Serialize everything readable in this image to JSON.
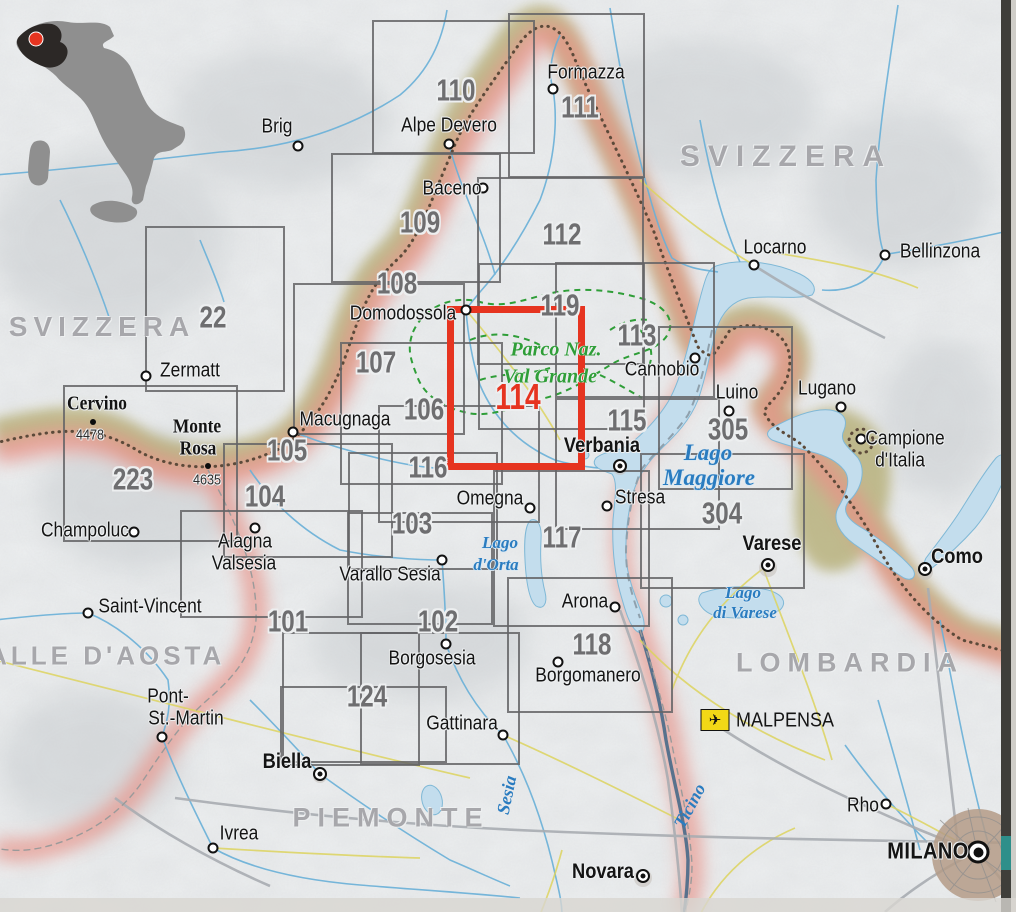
{
  "map": {
    "description": "Index map of hiking map sheets, Piedmont / Lake Maggiore area, with red highlighted sheet 114 Parco Nazionale Val Grande",
    "highlighted_sheet": "114"
  },
  "colors": {
    "paper": "#edeff0",
    "grid": "#68686a",
    "highlight_red": "#e63420",
    "park_green": "#2f9e38",
    "water_blue": "#2a7cc0",
    "region_gray": "#a7a7ab",
    "khaki_band": "#b2aa6e",
    "border_pink": "#e89287",
    "border_line": "#5c4a3a",
    "lake_fill": "#c3dded",
    "airport_yellow": "#f2d816",
    "urban_brown": "#b49b87"
  },
  "inset": {
    "name": "italy-locator",
    "marker": "red-dot",
    "marker_color": "#e63420"
  },
  "sheets": [
    {
      "number": "22",
      "x": 145,
      "y": 226,
      "w": 140,
      "h": 166,
      "lx": 213,
      "ly": 318
    },
    {
      "number": "110",
      "x": 372,
      "y": 20,
      "w": 163,
      "h": 134,
      "lx": 456,
      "ly": 91
    },
    {
      "number": "111",
      "x": 508,
      "y": 13,
      "w": 137,
      "h": 165,
      "lx": 580,
      "ly": 108
    },
    {
      "number": "109",
      "x": 331,
      "y": 153,
      "w": 170,
      "h": 130,
      "lx": 420,
      "ly": 223
    },
    {
      "number": "112",
      "x": 477,
      "y": 177,
      "w": 167,
      "h": 188,
      "lx": 562,
      "ly": 235
    },
    {
      "number": "108",
      "x": 293,
      "y": 283,
      "w": 172,
      "h": 152,
      "lx": 397,
      "ly": 284
    },
    {
      "number": "107",
      "x": 340,
      "y": 342,
      "w": 163,
      "h": 143,
      "lx": 376,
      "ly": 363
    },
    {
      "number": "119",
      "x": 478,
      "y": 263,
      "w": 167,
      "h": 167,
      "lx": 560,
      "ly": 306
    },
    {
      "number": "113",
      "x": 555,
      "y": 262,
      "w": 160,
      "h": 136,
      "lx": 637,
      "ly": 336
    },
    {
      "number": "106",
      "x": 378,
      "y": 405,
      "w": 162,
      "h": 118,
      "lx": 424,
      "ly": 410
    },
    {
      "number": "105",
      "x": 223,
      "y": 443,
      "w": 170,
      "h": 115,
      "lx": 287,
      "ly": 451
    },
    {
      "number": "104",
      "x": 180,
      "y": 510,
      "w": 183,
      "h": 108,
      "lx": 265,
      "ly": 497
    },
    {
      "number": "223",
      "x": 63,
      "y": 385,
      "w": 175,
      "h": 157,
      "lx": 133,
      "ly": 480
    },
    {
      "number": "116",
      "x": 348,
      "y": 452,
      "w": 150,
      "h": 118,
      "lx": 428,
      "ly": 468
    },
    {
      "number": "115",
      "x": 555,
      "y": 398,
      "w": 165,
      "h": 132,
      "lx": 627,
      "ly": 421
    },
    {
      "number": "305",
      "x": 658,
      "y": 326,
      "w": 135,
      "h": 164,
      "lx": 728,
      "ly": 430
    },
    {
      "number": "304",
      "x": 640,
      "y": 453,
      "w": 165,
      "h": 136,
      "lx": 722,
      "ly": 514
    },
    {
      "number": "103",
      "x": 347,
      "y": 512,
      "w": 146,
      "h": 113,
      "lx": 412,
      "ly": 524
    },
    {
      "number": "117",
      "x": 493,
      "y": 470,
      "w": 157,
      "h": 157,
      "lx": 562,
      "ly": 538
    },
    {
      "number": "101",
      "x": 282,
      "y": 632,
      "w": 138,
      "h": 134,
      "lx": 288,
      "ly": 622
    },
    {
      "number": "102",
      "x": 360,
      "y": 632,
      "w": 160,
      "h": 133,
      "lx": 438,
      "ly": 622
    },
    {
      "number": "118",
      "x": 507,
      "y": 577,
      "w": 166,
      "h": 136,
      "lx": 592,
      "ly": 645
    },
    {
      "number": "124",
      "x": 280,
      "y": 686,
      "w": 167,
      "h": 77,
      "lx": 367,
      "ly": 697
    },
    {
      "number": "114",
      "x": 447,
      "y": 306,
      "w": 138,
      "h": 164,
      "lx": 518,
      "ly": 398,
      "highlight": true
    }
  ],
  "places": [
    {
      "name": "Brig",
      "kind": "town",
      "dot": [
        298,
        146
      ],
      "lines": [
        {
          "t": "Brig",
          "x": 277,
          "y": 128
        }
      ]
    },
    {
      "name": "Formazza",
      "kind": "town",
      "dot": [
        553,
        89
      ],
      "lines": [
        {
          "t": "Formazza",
          "x": 586,
          "y": 74
        }
      ]
    },
    {
      "name": "Alpe Devero",
      "kind": "town",
      "dot": [
        449,
        144
      ],
      "lines": [
        {
          "t": "Alpe Devero",
          "x": 449,
          "y": 127
        }
      ]
    },
    {
      "name": "Baceno",
      "kind": "town",
      "dot": [
        483,
        188
      ],
      "lines": [
        {
          "t": "Baceno",
          "x": 452,
          "y": 190
        }
      ]
    },
    {
      "name": "Locarno",
      "kind": "town",
      "dot": [
        754,
        265
      ],
      "lines": [
        {
          "t": "Locarno",
          "x": 775,
          "y": 249
        }
      ]
    },
    {
      "name": "Bellinzona",
      "kind": "town",
      "dot": [
        885,
        255
      ],
      "lines": [
        {
          "t": "Bellinzona",
          "x": 940,
          "y": 253
        }
      ]
    },
    {
      "name": "Zermatt",
      "kind": "town",
      "dot": [
        146,
        376
      ],
      "lines": [
        {
          "t": "Zermatt",
          "x": 190,
          "y": 372
        }
      ]
    },
    {
      "name": "Domodossola",
      "kind": "town",
      "dot": [
        466,
        310
      ],
      "lines": [
        {
          "t": "Domodossola",
          "x": 403,
          "y": 315
        }
      ]
    },
    {
      "name": "Macugnaga",
      "kind": "town",
      "dot": [
        293,
        432
      ],
      "lines": [
        {
          "t": "Macugnaga",
          "x": 345,
          "y": 421
        }
      ]
    },
    {
      "name": "Cannobio",
      "kind": "town",
      "dot": [
        695,
        358
      ],
      "lines": [
        {
          "t": "Cannobio",
          "x": 662,
          "y": 371
        }
      ]
    },
    {
      "name": "Luino",
      "kind": "town",
      "dot": [
        729,
        411
      ],
      "lines": [
        {
          "t": "Luino",
          "x": 737,
          "y": 394
        }
      ]
    },
    {
      "name": "Lugano",
      "kind": "town",
      "dot": [
        841,
        407
      ],
      "lines": [
        {
          "t": "Lugano",
          "x": 827,
          "y": 390
        }
      ]
    },
    {
      "name": "Campione d'Italia",
      "kind": "town",
      "dot": [
        861,
        439
      ],
      "lines": [
        {
          "t": "Campione",
          "x": 905,
          "y": 440
        },
        {
          "t": "d'Italia",
          "x": 900,
          "y": 462
        }
      ]
    },
    {
      "name": "Champoluc",
      "kind": "town",
      "dot": [
        134,
        532
      ],
      "lines": [
        {
          "t": "Champoluc",
          "x": 85,
          "y": 532
        }
      ]
    },
    {
      "name": "Alagna Valsesia",
      "kind": "town",
      "dot": [
        255,
        528
      ],
      "lines": [
        {
          "t": "Alagna",
          "x": 245,
          "y": 543
        },
        {
          "t": "Valsesia",
          "x": 244,
          "y": 565
        }
      ]
    },
    {
      "name": "Saint-Vincent",
      "kind": "town",
      "dot": [
        88,
        613
      ],
      "lines": [
        {
          "t": "Saint-Vincent",
          "x": 150,
          "y": 608
        }
      ]
    },
    {
      "name": "Pont-St.-Martin",
      "kind": "town",
      "dot": [
        162,
        737
      ],
      "lines": [
        {
          "t": "Pont-",
          "x": 168,
          "y": 698
        },
        {
          "t": "St.-Martin",
          "x": 186,
          "y": 720
        }
      ]
    },
    {
      "name": "Ivrea",
      "kind": "town",
      "dot": [
        213,
        848
      ],
      "lines": [
        {
          "t": "Ivrea",
          "x": 239,
          "y": 835
        }
      ]
    },
    {
      "name": "Omegna",
      "kind": "town",
      "dot": [
        530,
        508
      ],
      "lines": [
        {
          "t": "Omegna",
          "x": 490,
          "y": 500
        }
      ]
    },
    {
      "name": "Stresa",
      "kind": "town",
      "dot": [
        607,
        506
      ],
      "lines": [
        {
          "t": "Stresa",
          "x": 640,
          "y": 499
        }
      ]
    },
    {
      "name": "Arona",
      "kind": "town",
      "dot": [
        615,
        607
      ],
      "lines": [
        {
          "t": "Arona",
          "x": 585,
          "y": 603
        }
      ]
    },
    {
      "name": "Borgosesia",
      "kind": "town",
      "dot": [
        446,
        644
      ],
      "lines": [
        {
          "t": "Borgosesia",
          "x": 432,
          "y": 660
        }
      ]
    },
    {
      "name": "Borgomanero",
      "kind": "town",
      "dot": [
        558,
        662
      ],
      "lines": [
        {
          "t": "Borgomanero",
          "x": 588,
          "y": 677
        }
      ]
    },
    {
      "name": "Gattinara",
      "kind": "town",
      "dot": [
        503,
        735
      ],
      "lines": [
        {
          "t": "Gattinara",
          "x": 462,
          "y": 725
        }
      ]
    },
    {
      "name": "Varallo Sesia",
      "kind": "town",
      "dot": [
        442,
        560
      ],
      "lines": [
        {
          "t": "Varallo Sesia",
          "x": 390,
          "y": 576
        }
      ]
    },
    {
      "name": "Rho",
      "kind": "town",
      "dot": [
        886,
        804
      ],
      "lines": [
        {
          "t": "Rho",
          "x": 863,
          "y": 807
        }
      ]
    },
    {
      "name": "Verbania",
      "kind": "city",
      "dot": [
        620,
        466
      ],
      "lines": [
        {
          "t": "Verbania",
          "x": 602,
          "y": 447
        }
      ]
    },
    {
      "name": "Varese",
      "kind": "city",
      "dot": [
        768,
        565
      ],
      "lines": [
        {
          "t": "Varese",
          "x": 772,
          "y": 545
        }
      ]
    },
    {
      "name": "Como",
      "kind": "city",
      "dot": [
        925,
        569
      ],
      "lines": [
        {
          "t": "Como",
          "x": 957,
          "y": 558
        }
      ]
    },
    {
      "name": "Biella",
      "kind": "city",
      "dot": [
        320,
        774
      ],
      "lines": [
        {
          "t": "Biella",
          "x": 287,
          "y": 763
        }
      ]
    },
    {
      "name": "Novara",
      "kind": "city",
      "dot": [
        643,
        876
      ],
      "lines": [
        {
          "t": "Novara",
          "x": 603,
          "y": 873
        }
      ]
    },
    {
      "name": "MILANO",
      "kind": "capital",
      "dot": [
        978,
        852
      ],
      "lines": [
        {
          "t": "MILANO",
          "x": 928,
          "y": 852
        }
      ]
    }
  ],
  "peaks": [
    {
      "name": "Cervino",
      "elev": "4478",
      "dot": [
        93,
        422
      ],
      "lines": [
        {
          "t": "Cervino",
          "x": 97,
          "y": 405
        }
      ],
      "elev_pos": [
        90,
        436
      ]
    },
    {
      "name": "Monte Rosa",
      "elev": "4635",
      "dot": [
        208,
        466
      ],
      "lines": [
        {
          "t": "Monte",
          "x": 197,
          "y": 428
        },
        {
          "t": "Rosa",
          "x": 198,
          "y": 450
        }
      ],
      "elev_pos": [
        207,
        481
      ]
    }
  ],
  "regions": [
    {
      "t": "SVIZZERA",
      "x": 786,
      "y": 157,
      "size": 30,
      "ls": 8
    },
    {
      "t": "SVIZZERA",
      "x": 102,
      "y": 327,
      "size": 28,
      "ls": 6
    },
    {
      "t": "VALLE D'AOSTA",
      "x": 97,
      "y": 656,
      "size": 26,
      "ls": 4
    },
    {
      "t": "LOMBARDIA",
      "x": 850,
      "y": 663,
      "size": 27,
      "ls": 7
    },
    {
      "t": "PIEMONTE",
      "x": 391,
      "y": 818,
      "size": 27,
      "ls": 7
    }
  ],
  "water_labels": [
    {
      "t": "Lago",
      "x": 708,
      "y": 453,
      "size": 23
    },
    {
      "t": "Maggiore",
      "x": 709,
      "y": 478,
      "size": 23
    },
    {
      "t": "Lago",
      "x": 500,
      "y": 543,
      "size": 17
    },
    {
      "t": "d'Orta",
      "x": 496,
      "y": 565,
      "size": 17
    },
    {
      "t": "Lago",
      "x": 743,
      "y": 593,
      "size": 17
    },
    {
      "t": "di Varese",
      "x": 745,
      "y": 613,
      "size": 17
    }
  ],
  "river_labels": [
    {
      "t": "Sesia",
      "x": 507,
      "y": 795,
      "rot": -78
    },
    {
      "t": "Ticino",
      "x": 690,
      "y": 806,
      "rot": -62
    }
  ],
  "park_label": [
    {
      "t": "Parco Naz.",
      "x": 556,
      "y": 350
    },
    {
      "t": "Val Grande",
      "x": 550,
      "y": 377
    }
  ],
  "airport": {
    "name": "MALPENSA",
    "icon": "airplane-icon",
    "box": [
      715,
      720
    ],
    "text": [
      736,
      721
    ]
  }
}
